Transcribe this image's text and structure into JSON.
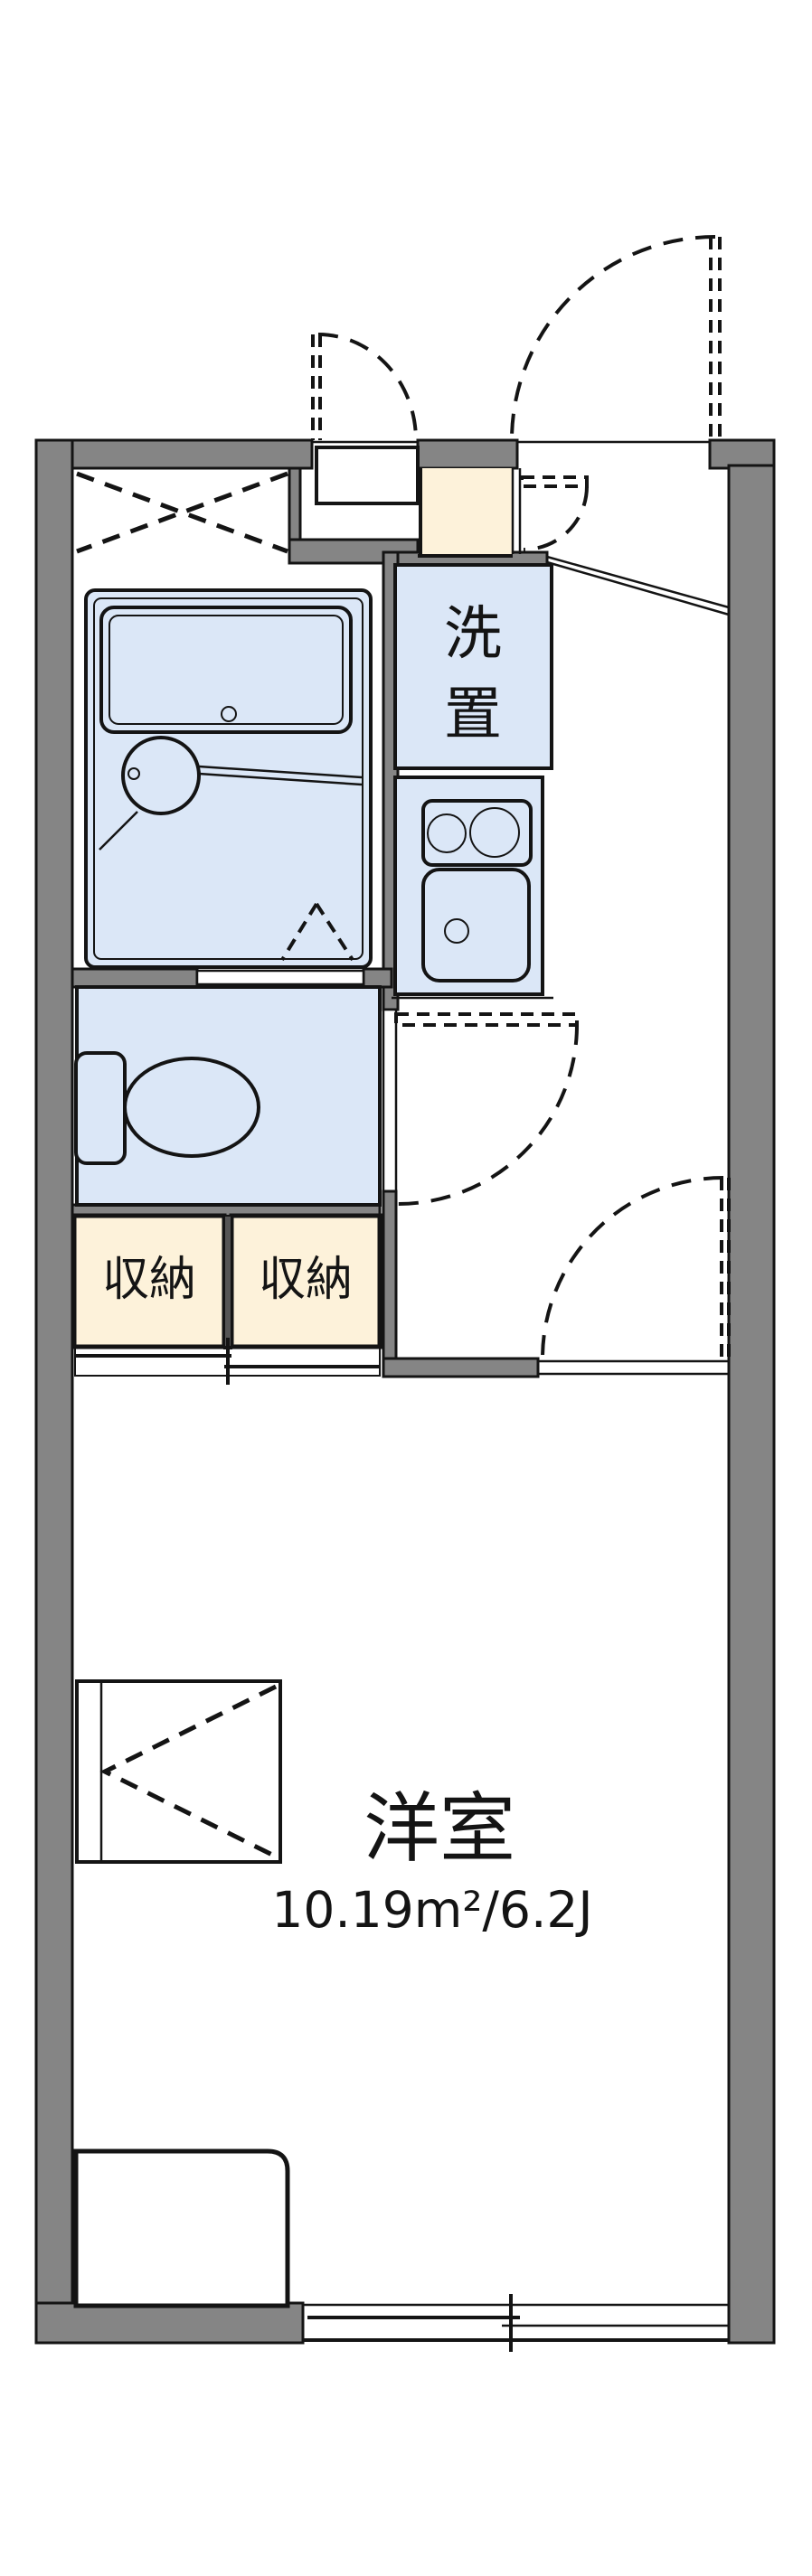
{
  "floorplan": {
    "labels": {
      "washer_place_line1": "洗",
      "washer_place_line2": "置",
      "storage_left": "収納",
      "storage_right": "収納",
      "room_name": "洋室",
      "room_area": "10.19m²/6.2J"
    },
    "colors": {
      "wall_gray": "#858585",
      "water_area_blue": "#dbe7f7",
      "storage_cream": "#fdf2da",
      "line_black": "#141414",
      "background": "#ffffff"
    }
  }
}
